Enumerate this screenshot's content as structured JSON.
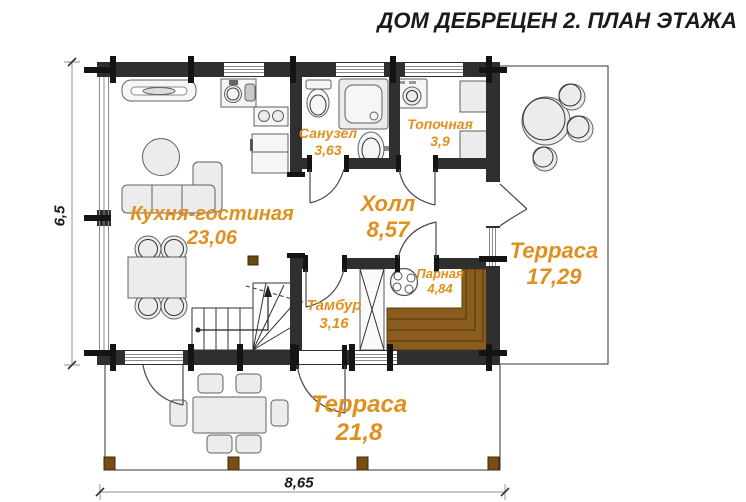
{
  "title": "ДОМ ДЕБРЕЦЕН 2. ПЛАН ЭТАЖА",
  "rooms": {
    "kitchen_living": {
      "name": "Кухня-гостиная",
      "area": "23,06"
    },
    "bathroom": {
      "name": "Санузел",
      "area": "3,63"
    },
    "boiler": {
      "name": "Топочная",
      "area": "3,9"
    },
    "hall": {
      "name": "Холл",
      "area": "8,57"
    },
    "terrace_right": {
      "name": "Терраса",
      "area": "17,29"
    },
    "sauna": {
      "name": "Парная",
      "area": "4,84"
    },
    "vestibule": {
      "name": "Тамбур",
      "area": "3,16"
    },
    "terrace_bottom": {
      "name": "Терраса",
      "area": "21,8"
    }
  },
  "dimensions": {
    "width_m": "8,65",
    "height_m": "6,5"
  },
  "colors": {
    "label": "#E0901E",
    "wall": "#2F2F2F",
    "bench": "#8A5C1E",
    "post": "#7A4E10",
    "title": "#1A1A1A"
  }
}
